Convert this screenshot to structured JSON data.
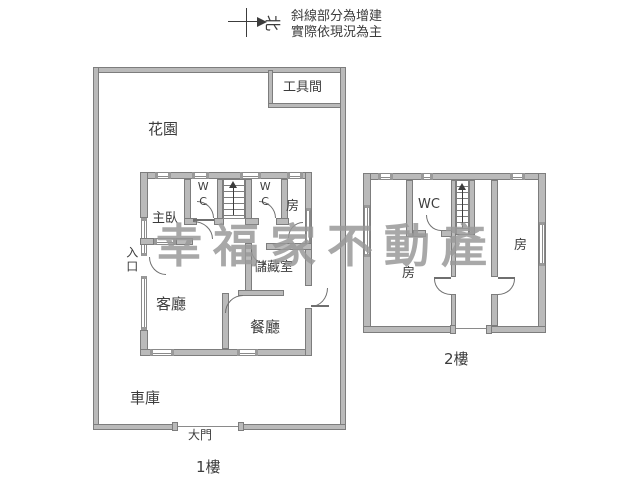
{
  "note": {
    "line1": "斜線部分為增建",
    "line2": "實際依現況為主"
  },
  "compass": {
    "north_label": "北"
  },
  "watermark": {
    "text": "幸福家不動產",
    "color": "#9a9a9a"
  },
  "colors": {
    "wall_fill": "#bababa",
    "wall_stroke": "#7d7d7d",
    "text": "#3c3c3c",
    "background": "#ffffff"
  },
  "floor1": {
    "floor_label": "1樓",
    "tool_room": "工具間",
    "garden": "花園",
    "master_bedroom": "主臥",
    "wc_left": "WC",
    "wc_right": "WC",
    "bedroom": "房",
    "entrance": "入口",
    "storage_room": "儲藏室",
    "living_room": "客廳",
    "dining_room": "餐廳",
    "garage": "車庫",
    "main_gate": "大門"
  },
  "floor2": {
    "floor_label": "2樓",
    "wc": "WC",
    "room_left": "房",
    "room_right": "房"
  }
}
